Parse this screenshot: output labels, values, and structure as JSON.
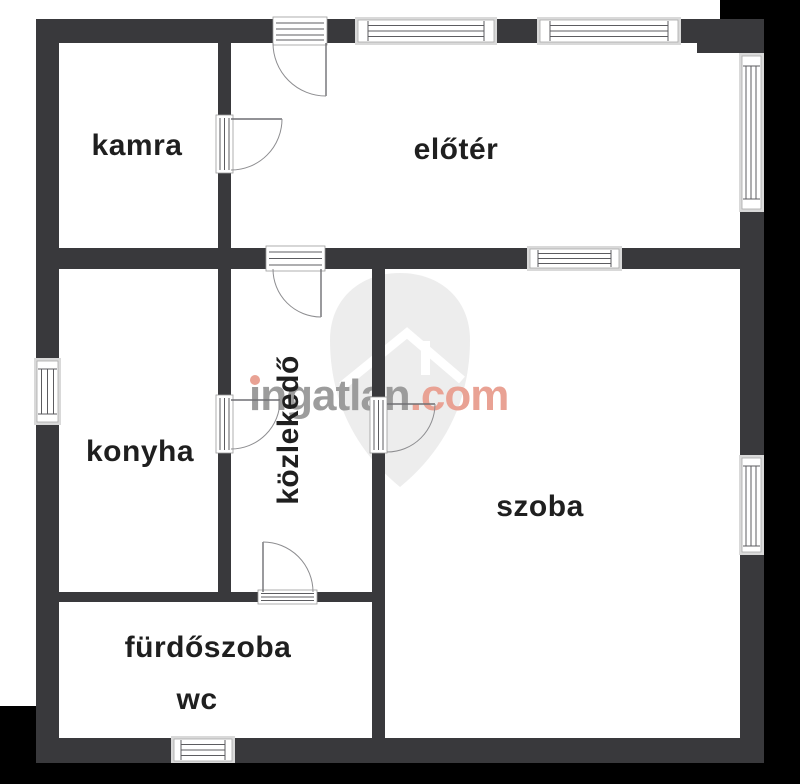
{
  "rooms": [
    {
      "id": "kamra",
      "label": "kamra"
    },
    {
      "id": "eloter",
      "label": "előtér"
    },
    {
      "id": "konyha",
      "label": "konyha"
    },
    {
      "id": "kozlekedo",
      "label": "közlekedő"
    },
    {
      "id": "szoba",
      "label": "szoba"
    },
    {
      "id": "furdoszoba",
      "label": "fürdőszoba"
    },
    {
      "id": "wc",
      "label": "wc"
    }
  ],
  "watermark": {
    "brand_first_letter": "i",
    "brand_rest": "ngatlan",
    "tld": ".com",
    "brand_color": "#9c9c9c",
    "tld_color": "#e9a294"
  },
  "colors": {
    "wall": "#39393c",
    "plan_background": "#ffffff",
    "outside_background": "#000000",
    "window_frame": "#d9d9d9",
    "label_text": "#1f1f1f",
    "watermark_shield": "#ededed"
  }
}
